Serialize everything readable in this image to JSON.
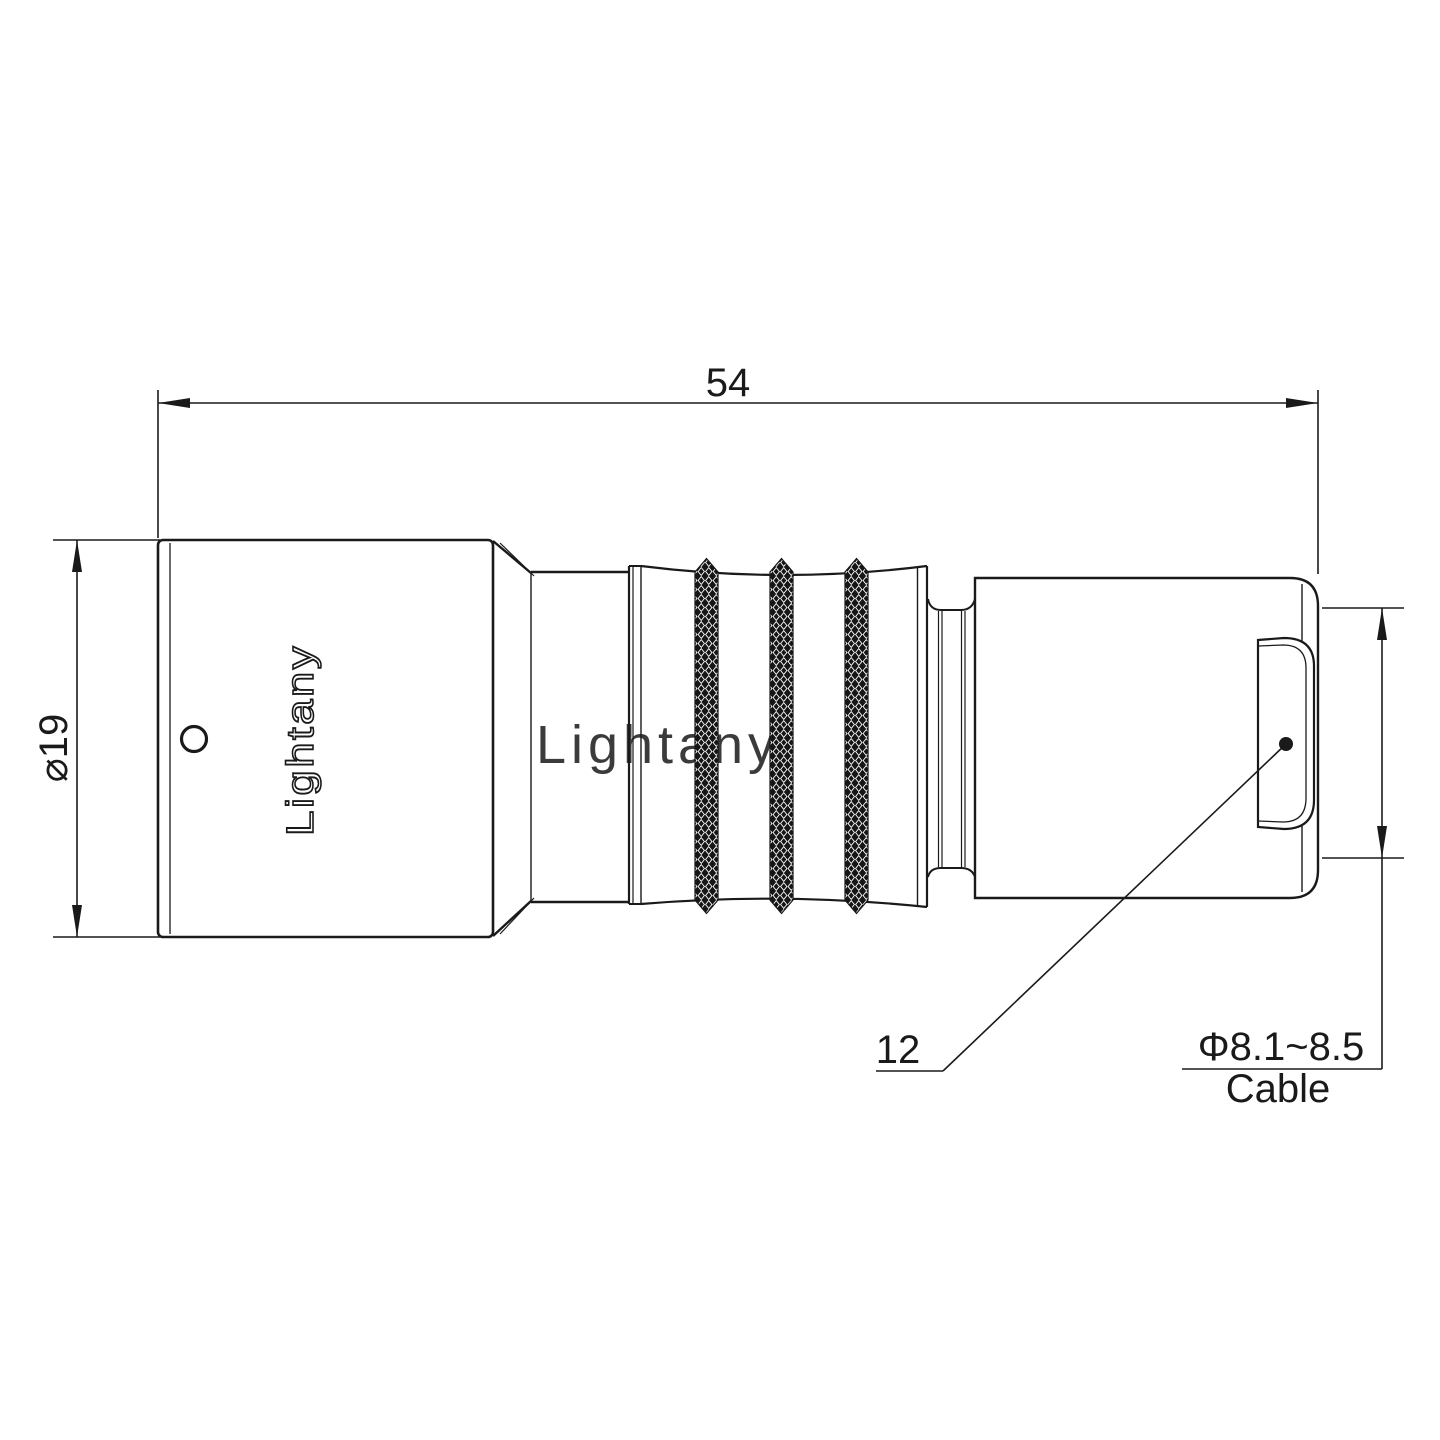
{
  "drawing": {
    "kind": "connector-technical-drawing",
    "background": "#ffffff",
    "line_color": "#1a1a1a"
  },
  "watermark": {
    "text": "Lightany",
    "color": "#f0b9b9"
  },
  "connector": {
    "engraving_text": "Lightany"
  },
  "dimensions": {
    "overall_length": "54",
    "body_diameter": "⌀19",
    "rear_dimension": "12",
    "cable_diameter": "Φ8.1~8.5",
    "cable_label": "Cable"
  }
}
